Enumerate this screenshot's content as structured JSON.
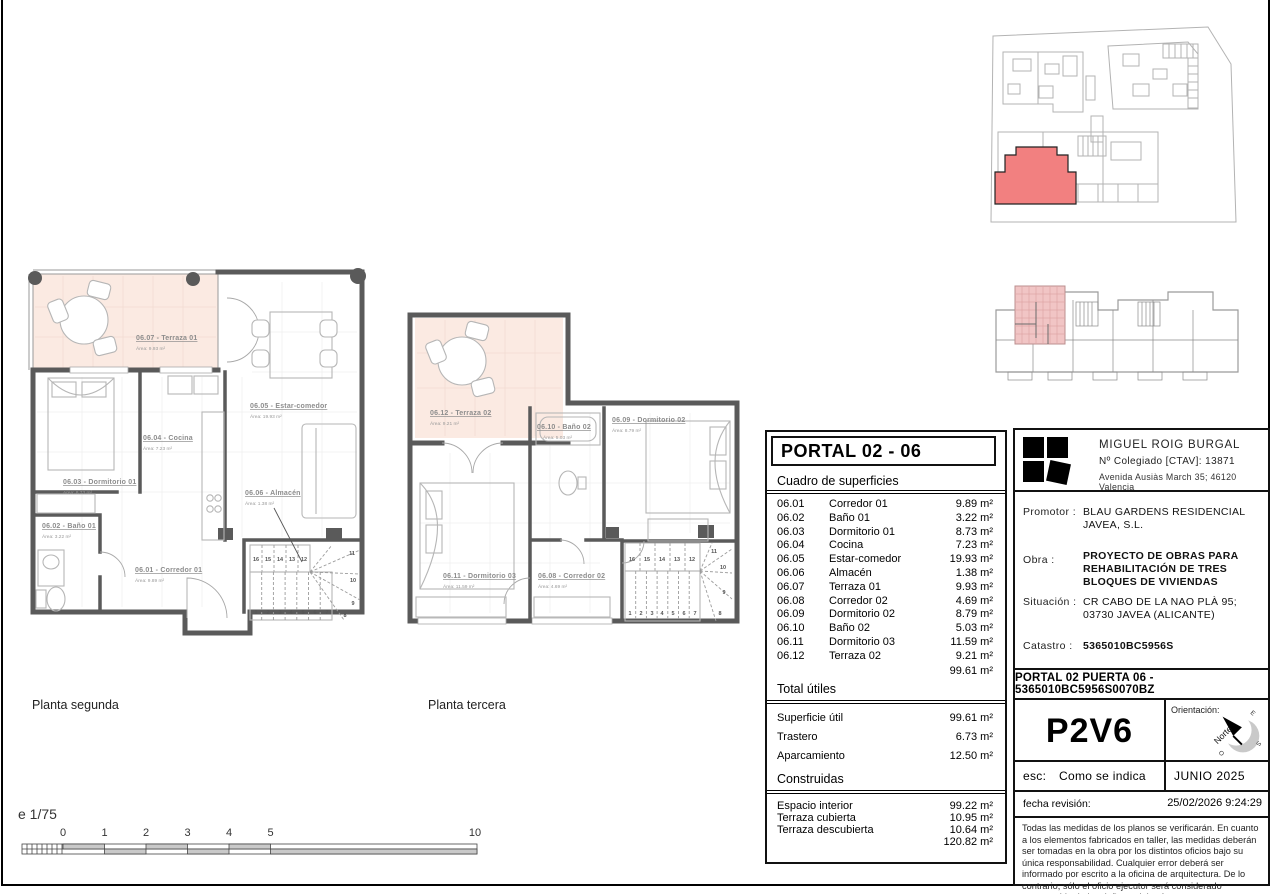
{
  "sheet": {
    "scale": {
      "label": "e 1/75",
      "ticks": [
        "0",
        "1",
        "2",
        "3",
        "4",
        "5",
        "10"
      ]
    }
  },
  "plans": {
    "segunda": {
      "name": "Planta segunda",
      "rooms": {
        "terraza01": {
          "title": "06.07 - Terraza 01",
          "area": "Área: 9.93 m²"
        },
        "estar": {
          "title": "06.05 - Estar-comedor",
          "area": "Área: 19.93 m²"
        },
        "cocina": {
          "title": "06.04 - Cocina",
          "area": "Área: 7.23 m²"
        },
        "dormitorio01": {
          "title": "06.03 - Dormitorio 01",
          "area": "Área: 8.73 m²"
        },
        "bano01": {
          "title": "06.02 - Baño 01",
          "area": "Área: 3.22 m²"
        },
        "corredor01": {
          "title": "06.01 - Corredor 01",
          "area": "Área: 9.89 m²"
        },
        "almacen": {
          "title": "06.06 - Almacén",
          "area": "Área: 1.38 m²"
        }
      },
      "stairs": {
        "lower": [
          "1",
          "2",
          "3",
          "4",
          "5",
          "6",
          "7"
        ],
        "upper": [
          "16",
          "15",
          "14",
          "13",
          "12"
        ],
        "fan": [
          "11",
          "10",
          "9",
          "8"
        ]
      }
    },
    "tercera": {
      "name": "Planta tercera",
      "rooms": {
        "terraza02": {
          "title": "06.12 - Terraza 02",
          "area": "Área: 9.21 m²"
        },
        "bano02": {
          "title": "06.10 - Baño 02",
          "area": "Área: 5.03 m²"
        },
        "dormitorio02": {
          "title": "06.09 - Dormitorio 02",
          "area": "Área: 8.79 m²"
        },
        "dormitorio03": {
          "title": "06.11 - Dormitorio 03",
          "area": "Área: 11.59 m²"
        },
        "corredor02": {
          "title": "06.08 - Corredor 02",
          "area": "Área: 4.69 m²"
        }
      },
      "stairs": {
        "lower": [
          "1",
          "2",
          "3",
          "4",
          "5",
          "6",
          "7"
        ],
        "upper": [
          "16",
          "15",
          "14",
          "13",
          "12"
        ],
        "fan": [
          "11",
          "10",
          "9",
          "8"
        ]
      }
    }
  },
  "surfaces": {
    "title": "PORTAL 02 - 06",
    "subtitle": "Cuadro de superficies",
    "rows": [
      {
        "code": "06.01",
        "name": "Corredor 01",
        "area": "9.89 m²"
      },
      {
        "code": "06.02",
        "name": "Baño 01",
        "area": "3.22 m²"
      },
      {
        "code": "06.03",
        "name": "Dormitorio 01",
        "area": "8.73 m²"
      },
      {
        "code": "06.04",
        "name": "Cocina",
        "area": "7.23 m²"
      },
      {
        "code": "06.05",
        "name": "Estar-comedor",
        "area": "19.93 m²"
      },
      {
        "code": "06.06",
        "name": "Almacén",
        "area": "1.38 m²"
      },
      {
        "code": "06.07",
        "name": "Terraza 01",
        "area": "9.93 m²"
      },
      {
        "code": "06.08",
        "name": "Corredor 02",
        "area": "4.69 m²"
      },
      {
        "code": "06.09",
        "name": "Dormitorio 02",
        "area": "8.79 m²"
      },
      {
        "code": "06.10",
        "name": "Baño 02",
        "area": "5.03 m²"
      },
      {
        "code": "06.11",
        "name": "Dormitorio 03",
        "area": "11.59 m²"
      },
      {
        "code": "06.12",
        "name": "Terraza 02",
        "area": "9.21 m²"
      }
    ],
    "rows_total": "99.61 m²",
    "utiles": {
      "title": "Total útiles",
      "rows": [
        {
          "name": "Superficie útil",
          "area": "99.61 m²"
        },
        {
          "name": "Trastero",
          "area": "6.73 m²"
        },
        {
          "name": "Aparcamiento",
          "area": "12.50 m²"
        }
      ]
    },
    "construidas": {
      "title": "Construidas",
      "rows": [
        {
          "name": "Espacio interior",
          "area": "99.22 m²"
        },
        {
          "name": "Terraza cubierta",
          "area": "10.95 m²"
        },
        {
          "name": "Terraza descubierta",
          "area": "10.64 m²"
        }
      ],
      "total": "120.82 m²"
    }
  },
  "title_block": {
    "architect": {
      "name": "MIGUEL ROIG BURGAL",
      "college": "Nº Colegiado [CTAV]:  13871",
      "address": "Avenida Ausiàs March 35; 46120 Valencia"
    },
    "promotor_label": "Promotor :",
    "promotor_value": "BLAU GARDENS RESIDENCIAL JAVEA, S.L.",
    "obra_label": "Obra :",
    "obra_value": "PROYECTO DE OBRAS PARA REHABILITACIÓN DE TRES BLOQUES DE VIVIENDAS",
    "situacion_label": "Situación :",
    "situacion_value": "CR CABO DE LA NAO PLÀ 95; 03730 JAVEA (ALICANTE)",
    "catastro_label": "Catastro :",
    "catastro_value": "5365010BC5956S",
    "reference": "PORTAL 02 PUERTA 06 - 5365010BC5956S0070BZ",
    "unit_code": "P2V6",
    "orientation_label": "Orientación:",
    "compass": {
      "north": "Norte",
      "east": "E",
      "south": "S",
      "west": "O"
    },
    "esc_label": "esc:",
    "esc_value": "Como se indica",
    "date": "JUNIO 2025",
    "revision_label": "fecha revisión:",
    "revision_value": "25/02/2026 9:24:29",
    "disclaimer": "Todas las medidas de los planos se verificarán. En cuanto a los elementos fabricados en taller, las medidas deberán ser tomadas en la obra por los distintos oficios bajo su única responsabilidad. Cualquier error deberá ser informado por escrito a la oficina de arquitectura. De lo contrario, sólo el oficio ejecutor será considerado responsable de los daños y deberá reparar a su costa."
  },
  "colors": {
    "wall_gray": "#5a5a5a",
    "terrace_pink": "#fbeae2",
    "highlight_red": "#f28080",
    "keyplan_pink": "#f1c5c5"
  }
}
